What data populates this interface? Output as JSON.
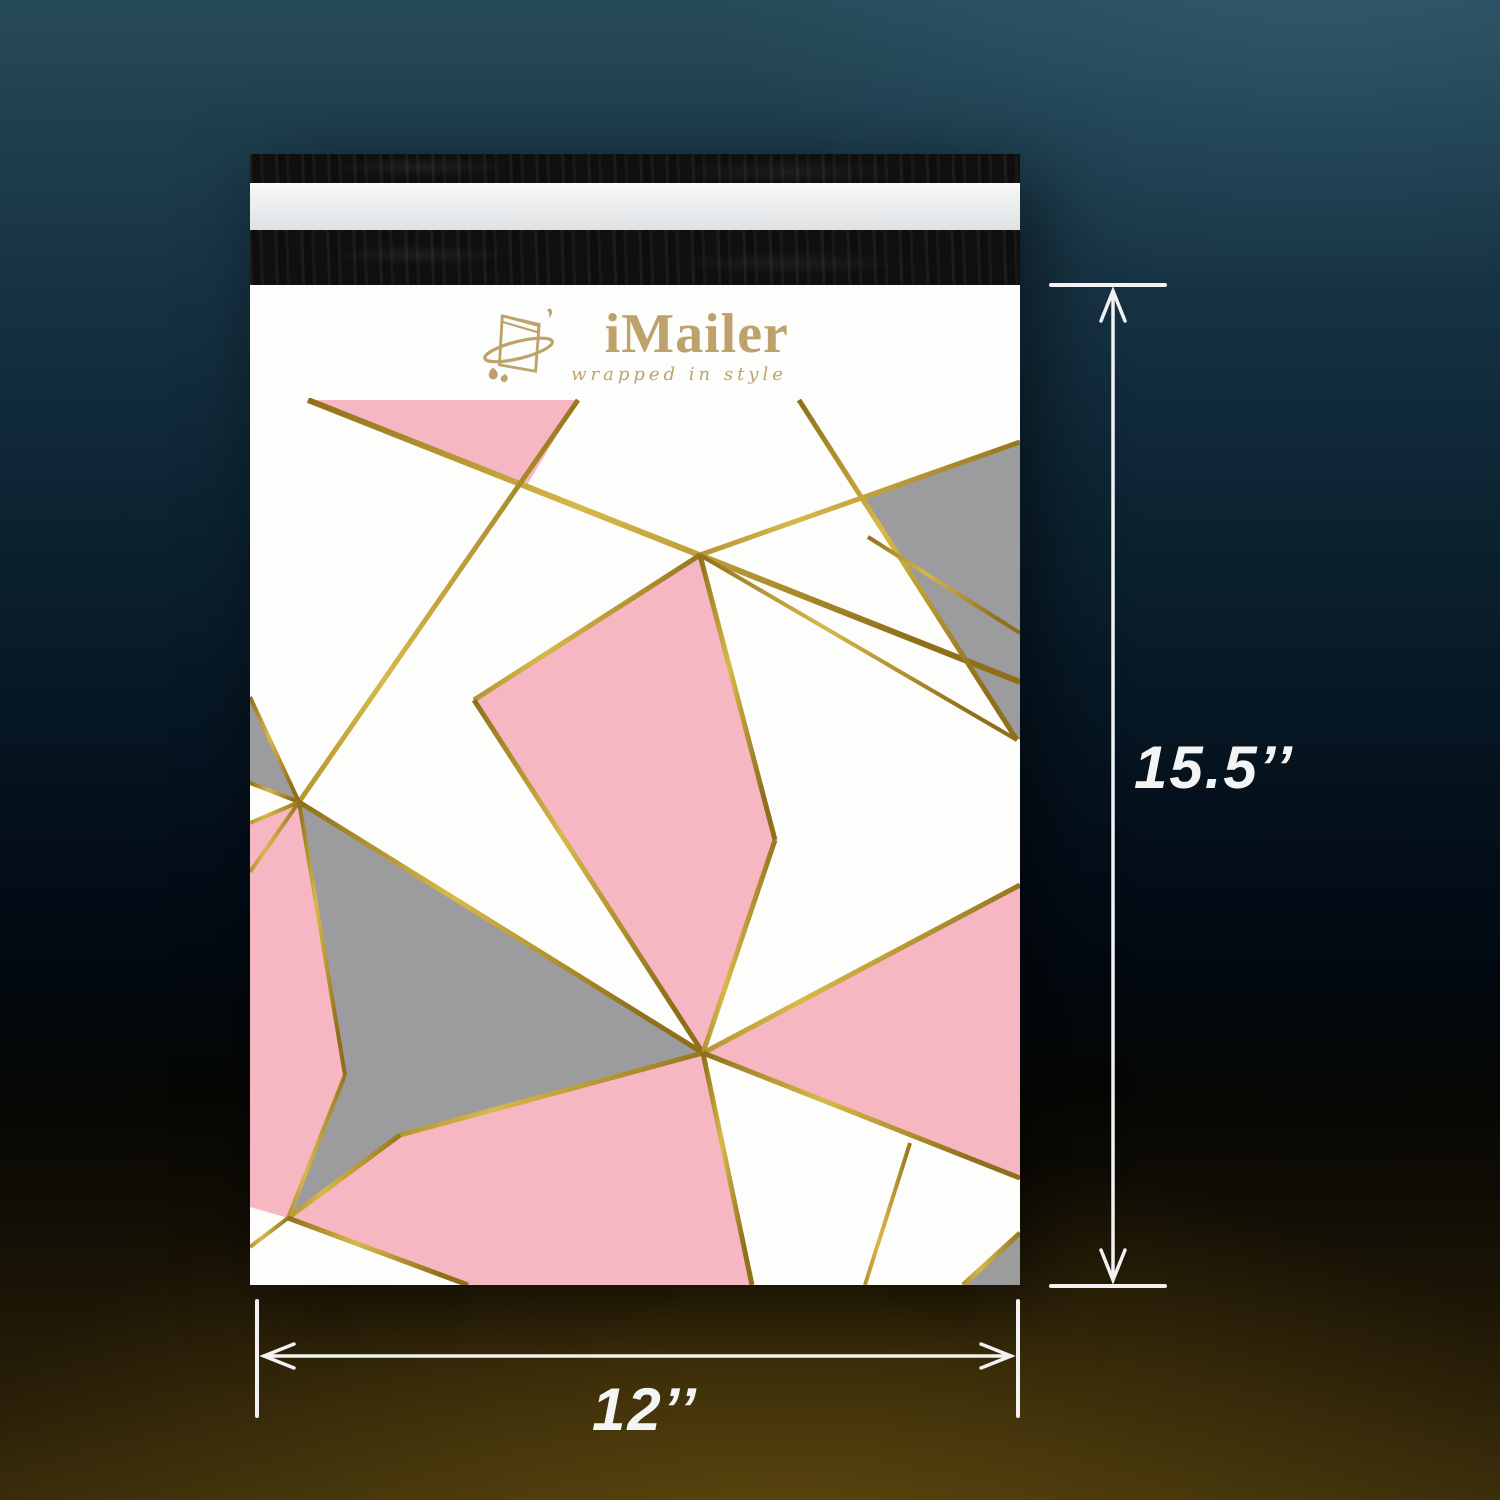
{
  "scene": {
    "background": {
      "top_teal": "#274a58",
      "mid_navy": "#0d2433",
      "dark_center": "#02070c",
      "bottom_amber": "#362a0a"
    }
  },
  "product": {
    "brand": "iMailer",
    "tagline": "wrapped in style",
    "logo_color": "#bda26b",
    "envelope": {
      "body_color": "#fdfdfb",
      "flap_black": "#151413",
      "flap_liner": "#edeff1",
      "pink": "#f7b7c2",
      "gray": "#9c9b9e",
      "gold_dark": "#8f6f1a",
      "gold_mid": "#d7b84a",
      "pattern": {
        "viewbox": "0 0 770 1000",
        "band_height": 113,
        "polygons": [
          {
            "name": "top-pink-triangle",
            "fill": "pink",
            "points": "58,115 328,115 277,200"
          },
          {
            "name": "top-right-gray",
            "fill": "gray",
            "points": "610,215 770,157 770,455"
          },
          {
            "name": "center-pink-kite",
            "fill": "pink",
            "points": "450,270 525,555 453,768 224,415"
          },
          {
            "name": "right-pink-triangle",
            "fill": "pink",
            "points": "453,768 770,600 770,893"
          },
          {
            "name": "left-gray-triangle",
            "fill": "gray",
            "points": "0,412 49,517 0,498"
          },
          {
            "name": "gray-arrow",
            "fill": "gray",
            "points": "49,517 453,768 150,850 38,933 95,790"
          },
          {
            "name": "left-pink",
            "fill": "pink",
            "points": "0,538 49,517 95,790 38,933 0,922"
          },
          {
            "name": "bottom-pink",
            "fill": "pink",
            "points": "453,768 502,1000 218,1000 38,933 150,850"
          },
          {
            "name": "corner-gray",
            "fill": "gray",
            "points": "713,1000 770,948 770,1000"
          }
        ],
        "lines": [
          {
            "p": [
              58,
              115,
              770,
              397
            ],
            "w": 6
          },
          {
            "p": [
              328,
              115,
              49,
              517
            ],
            "w": 5
          },
          {
            "p": [
              49,
              517,
              0,
              587
            ],
            "w": 4
          },
          {
            "p": [
              450,
              270,
              770,
              157
            ],
            "w": 5
          },
          {
            "p": [
              549,
              115,
              767,
              455
            ],
            "w": 5
          },
          {
            "p": [
              450,
              270,
              767,
              455
            ],
            "w": 4
          },
          {
            "p": [
              450,
              270,
              224,
              415
            ],
            "w": 5
          },
          {
            "p": [
              224,
              415,
              453,
              768
            ],
            "w": 5
          },
          {
            "p": [
              450,
              270,
              525,
              555
            ],
            "w": 5
          },
          {
            "p": [
              525,
              555,
              453,
              768
            ],
            "w": 5
          },
          {
            "p": [
              49,
              517,
              0,
              412
            ],
            "w": 4
          },
          {
            "p": [
              49,
              517,
              0,
              498
            ],
            "w": 4
          },
          {
            "p": [
              49,
              517,
              0,
              538
            ],
            "w": 4
          },
          {
            "p": [
              49,
              517,
              453,
              768
            ],
            "w": 5
          },
          {
            "p": [
              453,
              768,
              150,
              850
            ],
            "w": 5
          },
          {
            "p": [
              150,
              850,
              38,
              933
            ],
            "w": 5
          },
          {
            "p": [
              49,
              517,
              95,
              790
            ],
            "w": 4
          },
          {
            "p": [
              95,
              790,
              38,
              933
            ],
            "w": 4
          },
          {
            "p": [
              38,
              933,
              0,
              962
            ],
            "w": 4
          },
          {
            "p": [
              38,
              933,
              218,
              1000
            ],
            "w": 5
          },
          {
            "p": [
              453,
              768,
              502,
              1000
            ],
            "w": 5
          },
          {
            "p": [
              453,
              768,
              770,
              600
            ],
            "w": 5
          },
          {
            "p": [
              453,
              768,
              770,
              893
            ],
            "w": 5
          },
          {
            "p": [
              660,
              858,
              615,
              1000
            ],
            "w": 4
          },
          {
            "p": [
              713,
              1000,
              770,
              948
            ],
            "w": 5
          },
          {
            "p": [
              618,
              252,
              770,
              348
            ],
            "w": 4
          }
        ]
      }
    }
  },
  "annotations": {
    "line_color": "#f2f2f2",
    "height_label": "15.5’’",
    "width_label": "12’’"
  }
}
